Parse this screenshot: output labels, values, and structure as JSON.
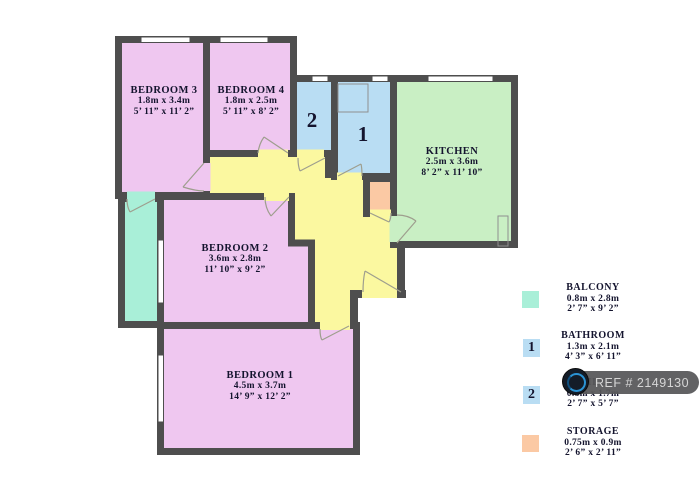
{
  "plan": {
    "rooms": [
      {
        "name": "BEDROOM 3",
        "metric": "1.8m x 3.4m",
        "imperial": "5’ 11” x 11’ 2”"
      },
      {
        "name": "BEDROOM 4",
        "metric": "1.8m x 2.5m",
        "imperial": "5’ 11” x 8’ 2”"
      },
      {
        "name": "KITCHEN",
        "metric": "2.5m x 3.6m",
        "imperial": "8’ 2” x 11’ 10”"
      },
      {
        "name": "BEDROOM 2",
        "metric": "3.6m x 2.8m",
        "imperial": "11’ 10” x 9’ 2”"
      },
      {
        "name": "BEDROOM 1",
        "metric": "4.5m x 3.7m",
        "imperial": "14’ 9” x 12’ 2”"
      }
    ],
    "markers": [
      {
        "label": "2"
      },
      {
        "label": "1"
      }
    ]
  },
  "legend": {
    "items": [
      {
        "name": "BALCONY",
        "metric": "0.8m x 2.8m",
        "imperial": "2’ 7” x 9’ 2”",
        "marker": "",
        "swatch_color": "#a9efd8"
      },
      {
        "name": "BATHROOM",
        "metric": "1.3m x 2.1m",
        "imperial": "4’ 3” x 6’ 11”",
        "marker": "1",
        "swatch_color": "#b9ddf3"
      },
      {
        "name": "TOILET",
        "metric": "0.8m x 1.7m",
        "imperial": "2’ 7” x 5’ 7”",
        "marker": "2",
        "swatch_color": "#b9ddf3"
      },
      {
        "name": "STORAGE",
        "metric": "0.75m x 0.9m",
        "imperial": "2’ 6” x 2’ 11”",
        "marker": "",
        "swatch_color": "#fbc9a4"
      }
    ]
  },
  "watermark": {
    "ref": "REF # 2149130"
  },
  "colors": {
    "bedroom": "#efc7f0",
    "kitchen": "#c9efc4",
    "bathroom": "#b9ddf3",
    "hallway": "#fbf8a0",
    "balcony": "#a9efd8",
    "storage": "#fbc9a4",
    "wall": "#4e4e4e",
    "watermark_bg": "#58585a",
    "text": "#14142e"
  }
}
